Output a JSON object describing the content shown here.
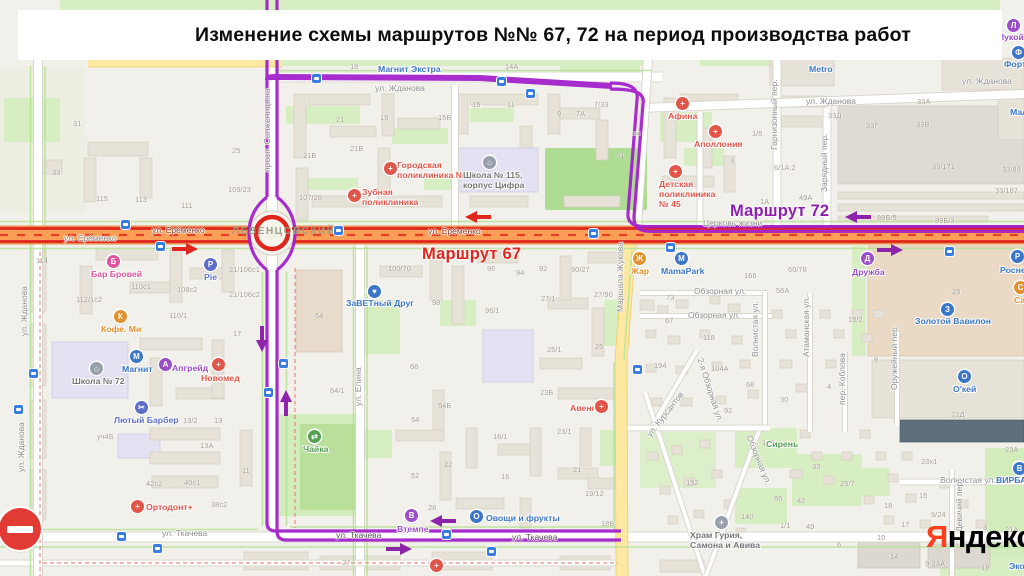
{
  "banner": {
    "title": "Изменение схемы маршрутов №№ 67, 72 на период производства работ"
  },
  "routes": {
    "r67": {
      "label": "Маршрут 67",
      "color": "#e0251c",
      "x": 422,
      "y": 245
    },
    "r72": {
      "label": "Маршрут 72",
      "color": "#a11ccb",
      "label_color": "#8d1fae",
      "x": 730,
      "y": 202
    }
  },
  "district": {
    "name": "ЛЕВЕНЦОВСКИЙ",
    "x": 232,
    "y": 226
  },
  "watermark": {
    "first": "Я",
    "rest": "ндекс",
    "accent": "#fc3f1d",
    "x": 926,
    "y": 519
  },
  "no_entry": {
    "x": 20,
    "y": 529
  },
  "colors": {
    "blue": "#3b76c9",
    "navy": "#5f6fc9",
    "red": "#e25549",
    "purple": "#9a4fc9",
    "orange": "#e2902e",
    "green": "#57a153",
    "pink": "#dd559c",
    "gray": "#767676",
    "school": "#98a1ab"
  },
  "map": {
    "streets": [
      {
        "t": "просп. Солженицына",
        "x": 263,
        "y": 172,
        "r": -90
      },
      {
        "t": "ул. Жданова",
        "x": 375,
        "y": 84
      },
      {
        "t": "ул. Жданова",
        "x": 806,
        "y": 97
      },
      {
        "t": "ул. Жданова",
        "x": 962,
        "y": 77
      },
      {
        "t": "ул. Ерёменко",
        "x": 152,
        "y": 226,
        "c": "#8a4634"
      },
      {
        "t": "ул. Ерёменко",
        "x": 64,
        "y": 234
      },
      {
        "t": "ул. Ерёменко",
        "x": 428,
        "y": 227,
        "c": "#8a4634"
      },
      {
        "t": "Гарнизонный пер.",
        "x": 770,
        "y": 150,
        "r": -90
      },
      {
        "t": "Зарядный пер.",
        "x": 820,
        "y": 192,
        "r": -90
      },
      {
        "t": "Маршала Жукова",
        "x": 616,
        "y": 312,
        "r": -90
      },
      {
        "t": "ул. Елина",
        "x": 354,
        "y": 406,
        "r": -90
      },
      {
        "t": "ул. Ткачева",
        "x": 162,
        "y": 529
      },
      {
        "t": "ул. Ткачева",
        "x": 336,
        "y": 531,
        "c": "#5c4f5a"
      },
      {
        "t": "ул. Ткачева",
        "x": 512,
        "y": 533,
        "c": "#5c4f5a"
      },
      {
        "t": "Обзорная ул.",
        "x": 694,
        "y": 287
      },
      {
        "t": "Обзорная ул.",
        "x": 688,
        "y": 311
      },
      {
        "t": "Обзорная ул.",
        "x": 753,
        "y": 434,
        "r": 68
      },
      {
        "t": "2-я Обзорная ул.",
        "x": 704,
        "y": 357,
        "r": 72
      },
      {
        "t": "ул. Курсантов",
        "x": 645,
        "y": 433,
        "r": -52
      },
      {
        "t": "Волнистая ул.",
        "x": 751,
        "y": 357,
        "r": -90
      },
      {
        "t": "Волнистая ул.",
        "x": 940,
        "y": 476
      },
      {
        "t": "Атаманская ул.",
        "x": 802,
        "y": 357,
        "r": -90
      },
      {
        "t": "пер. Коблова",
        "x": 838,
        "y": 405,
        "r": -90
      },
      {
        "t": "Оружейный пер.",
        "x": 890,
        "y": 390,
        "r": -90
      },
      {
        "t": "Девичий пер.",
        "x": 955,
        "y": 532,
        "r": -90
      },
      {
        "t": "ул. Жданова",
        "x": 20,
        "y": 336,
        "r": -90
      },
      {
        "t": "ул. Жданова",
        "x": 17,
        "y": 472,
        "r": -90
      },
      {
        "t": "Церковь жизни",
        "x": 703,
        "y": 219
      }
    ],
    "pois": [
      {
        "t": "Магнит Экстра",
        "x": 378,
        "y": 64,
        "c": "blue"
      },
      {
        "t": "Metro",
        "x": 809,
        "y": 64,
        "c": "blue"
      },
      {
        "t": "Лукойл",
        "x": 998,
        "y": 32,
        "c": "purple",
        "icon": {
          "x": 1007,
          "y": 19,
          "bg": "purple",
          "g": "Л"
        }
      },
      {
        "t": "Форту",
        "x": 1004,
        "y": 59,
        "c": "blue",
        "icon": {
          "x": 1012,
          "y": 46,
          "bg": "blue",
          "g": "Ф"
        }
      },
      {
        "t": "Мал",
        "x": 1010,
        "y": 107,
        "c": "blue"
      },
      {
        "t": "Афина",
        "x": 668,
        "y": 111,
        "c": "red",
        "icon": {
          "x": 676,
          "y": 97,
          "bg": "red",
          "g": "+"
        }
      },
      {
        "t": "Аполлония",
        "x": 694,
        "y": 139,
        "c": "red",
        "icon": {
          "x": 709,
          "y": 125,
          "bg": "red",
          "g": "+"
        }
      },
      {
        "t": "Городская\nполиклиника №42",
        "x": 397,
        "y": 160,
        "c": "red",
        "icon": {
          "x": 384,
          "y": 162,
          "bg": "red",
          "g": "+"
        }
      },
      {
        "t": "Школа № 115,\nкорпус Цифра",
        "x": 463,
        "y": 170,
        "c": "gray",
        "icon": {
          "x": 483,
          "y": 156,
          "bg": "school",
          "g": "⌂"
        }
      },
      {
        "t": "Зубная\nполиклиника",
        "x": 362,
        "y": 187,
        "c": "red",
        "icon": {
          "x": 348,
          "y": 189,
          "bg": "red",
          "g": "+"
        }
      },
      {
        "t": "Детская\nполиклиника\n№ 45",
        "x": 659,
        "y": 179,
        "c": "red",
        "icon": {
          "x": 669,
          "y": 165,
          "bg": "red",
          "g": "+"
        }
      },
      {
        "t": "Бар Бровей",
        "x": 91,
        "y": 269,
        "c": "pink",
        "icon": {
          "x": 107,
          "y": 255,
          "bg": "pink",
          "g": "Б"
        }
      },
      {
        "t": "Pie",
        "x": 204,
        "y": 272,
        "c": "navy",
        "icon": {
          "x": 204,
          "y": 258,
          "bg": "navy",
          "g": "P"
        }
      },
      {
        "t": "Кофе. Ми",
        "x": 101,
        "y": 324,
        "c": "orange",
        "icon": {
          "x": 114,
          "y": 310,
          "bg": "orange",
          "g": "К"
        }
      },
      {
        "t": "Магнит",
        "x": 122,
        "y": 364,
        "c": "blue",
        "icon": {
          "x": 130,
          "y": 350,
          "bg": "blue",
          "g": "М"
        }
      },
      {
        "t": "Апгрейд",
        "x": 172,
        "y": 363,
        "c": "purple",
        "icon": {
          "x": 159,
          "y": 358,
          "bg": "purple",
          "g": "А"
        }
      },
      {
        "t": "Новомед",
        "x": 201,
        "y": 373,
        "c": "red",
        "icon": {
          "x": 212,
          "y": 358,
          "bg": "red",
          "g": "+"
        }
      },
      {
        "t": "Школа № 72",
        "x": 72,
        "y": 376,
        "c": "gray",
        "icon": {
          "x": 90,
          "y": 362,
          "bg": "school",
          "g": "⌂"
        }
      },
      {
        "t": "Лютый Барбер",
        "x": 114,
        "y": 415,
        "c": "navy",
        "icon": {
          "x": 135,
          "y": 401,
          "bg": "navy",
          "g": "✂"
        }
      },
      {
        "t": "Ортодонт+",
        "x": 146,
        "y": 502,
        "c": "red",
        "icon": {
          "x": 131,
          "y": 500,
          "bg": "red",
          "g": "+"
        }
      },
      {
        "t": "ЗаВЕТный Друг",
        "x": 346,
        "y": 298,
        "c": "blue",
        "icon": {
          "x": 368,
          "y": 285,
          "bg": "blue",
          "g": "♥"
        }
      },
      {
        "t": "Чайка",
        "x": 303,
        "y": 444,
        "c": "green",
        "icon": {
          "x": 308,
          "y": 430,
          "bg": "green",
          "g": "⇄"
        }
      },
      {
        "t": "Втемпе",
        "x": 397,
        "y": 524,
        "c": "purple",
        "icon": {
          "x": 405,
          "y": 509,
          "bg": "purple",
          "g": "В"
        }
      },
      {
        "t": "Овощи и фрукты",
        "x": 486,
        "y": 513,
        "c": "blue",
        "icon": {
          "x": 470,
          "y": 510,
          "bg": "blue",
          "g": "О"
        }
      },
      {
        "t": "Авеню",
        "x": 570,
        "y": 403,
        "c": "red",
        "icon": {
          "x": 595,
          "y": 400,
          "bg": "red",
          "g": "+"
        }
      },
      {
        "t": "Жар",
        "x": 631,
        "y": 266,
        "c": "orange",
        "icon": {
          "x": 633,
          "y": 252,
          "bg": "orange",
          "g": "Ж"
        }
      },
      {
        "t": "MamaPark",
        "x": 661,
        "y": 266,
        "c": "blue",
        "icon": {
          "x": 675,
          "y": 252,
          "bg": "blue",
          "g": "М"
        }
      },
      {
        "t": "Дружба",
        "x": 852,
        "y": 267,
        "c": "purple",
        "icon": {
          "x": 861,
          "y": 252,
          "bg": "purple",
          "g": "Д"
        }
      },
      {
        "t": "Золотой Вавилон",
        "x": 915,
        "y": 316,
        "c": "blue",
        "icon": {
          "x": 941,
          "y": 303,
          "bg": "blue",
          "g": "З"
        }
      },
      {
        "t": "О'кей",
        "x": 953,
        "y": 384,
        "c": "blue",
        "icon": {
          "x": 958,
          "y": 370,
          "bg": "blue",
          "g": "О"
        }
      },
      {
        "t": "Роснефть",
        "x": 1000,
        "y": 265,
        "c": "blue",
        "icon": {
          "x": 1011,
          "y": 250,
          "bg": "blue",
          "g": "Р"
        }
      },
      {
        "t": "Са",
        "x": 1014,
        "y": 295,
        "c": "orange",
        "icon": {
          "x": 1014,
          "y": 281,
          "bg": "orange",
          "g": "С"
        }
      },
      {
        "t": "Храм Гурия,\nСамона и Авива",
        "x": 690,
        "y": 530,
        "c": "gray",
        "icon": {
          "x": 715,
          "y": 516,
          "bg": "school",
          "g": "+"
        }
      },
      {
        "t": "Сирень",
        "x": 766,
        "y": 439,
        "c": "green"
      },
      {
        "t": "ВИРБА",
        "x": 996,
        "y": 475,
        "c": "blue",
        "icon": {
          "x": 1013,
          "y": 462,
          "bg": "blue",
          "g": "В"
        }
      },
      {
        "t": "Эко",
        "x": 1009,
        "y": 561,
        "c": "blue"
      },
      {
        "t": "",
        "x": 437,
        "y": 566,
        "c": "red",
        "icon": {
          "x": 430,
          "y": 559,
          "bg": "red",
          "g": "+"
        }
      }
    ],
    "numbers": [
      [
        "31",
        73,
        120
      ],
      [
        "33",
        52,
        169
      ],
      [
        "25",
        232,
        147
      ],
      [
        "115",
        96,
        195
      ],
      [
        "113",
        135,
        196
      ],
      [
        "111",
        181,
        202
      ],
      [
        "109/23",
        228,
        186
      ],
      [
        "107/20",
        299,
        194
      ],
      [
        "18",
        350,
        63
      ],
      [
        "14А",
        505,
        63
      ],
      [
        "21",
        336,
        116
      ],
      [
        "19",
        380,
        114
      ],
      [
        "15Б",
        438,
        114
      ],
      [
        "15",
        472,
        101
      ],
      [
        "11",
        507,
        101
      ],
      [
        "9",
        557,
        110
      ],
      [
        "7А",
        576,
        110
      ],
      [
        "7/33",
        594,
        101
      ],
      [
        "21Б",
        303,
        152
      ],
      [
        "21В",
        350,
        145
      ],
      [
        "31",
        616,
        152
      ],
      [
        "34",
        632,
        130
      ],
      [
        "1/5",
        752,
        130
      ],
      [
        "3",
        730,
        157
      ],
      [
        "6/1А:2",
        774,
        164
      ],
      [
        "1А",
        760,
        198
      ],
      [
        "49А",
        799,
        194
      ],
      [
        "33А",
        917,
        98
      ],
      [
        "33Д",
        828,
        112
      ],
      [
        "33Г",
        866,
        122
      ],
      [
        "33В",
        916,
        121
      ],
      [
        "33/171",
        932,
        163
      ],
      [
        "33/89",
        1002,
        166
      ],
      [
        "33/187",
        995,
        187
      ],
      [
        "89Б/5",
        877,
        214
      ],
      [
        "89Б/3",
        935,
        217
      ],
      [
        "114",
        36,
        257
      ],
      [
        "112/1с2",
        76,
        296
      ],
      [
        "110с1",
        131,
        283
      ],
      [
        "108с2",
        177,
        286
      ],
      [
        "110/1",
        169,
        312
      ],
      [
        "21/106с1",
        229,
        266
      ],
      [
        "21/106с2",
        229,
        291
      ],
      [
        "17",
        233,
        330
      ],
      [
        "64",
        315,
        312
      ],
      [
        "64/1",
        330,
        387
      ],
      [
        "уч4Б",
        97,
        433
      ],
      [
        "13/2",
        183,
        417
      ],
      [
        "13",
        214,
        417
      ],
      [
        "13А",
        200,
        442
      ],
      [
        "42с2",
        146,
        480
      ],
      [
        "40с1",
        184,
        479
      ],
      [
        "38с2",
        211,
        501
      ],
      [
        "27",
        342,
        559
      ],
      [
        "100/70",
        388,
        265
      ],
      [
        "98",
        432,
        299
      ],
      [
        "96",
        487,
        265
      ],
      [
        "94",
        516,
        269
      ],
      [
        "92",
        539,
        265
      ],
      [
        "90/27",
        571,
        266
      ],
      [
        "96/1",
        485,
        307
      ],
      [
        "27/1",
        541,
        295
      ],
      [
        "27/90",
        594,
        291
      ],
      [
        "66",
        410,
        363
      ],
      [
        "25/1",
        547,
        346
      ],
      [
        "25",
        595,
        343
      ],
      [
        "23Б",
        540,
        389
      ],
      [
        "54Б",
        438,
        402
      ],
      [
        "54",
        411,
        416
      ],
      [
        "16/1",
        493,
        433
      ],
      [
        "23/1",
        557,
        428
      ],
      [
        "22",
        444,
        461
      ],
      [
        "52",
        411,
        472
      ],
      [
        "16",
        501,
        473
      ],
      [
        "21",
        573,
        466
      ],
      [
        "28",
        428,
        504
      ],
      [
        "19/12",
        585,
        490
      ],
      [
        "18Б",
        601,
        520
      ],
      [
        "11",
        242,
        467
      ],
      [
        "60/78",
        788,
        266
      ],
      [
        "56А",
        776,
        287
      ],
      [
        "166",
        744,
        272
      ],
      [
        "73",
        666,
        294
      ],
      [
        "67",
        665,
        317
      ],
      [
        "118",
        703,
        334
      ],
      [
        "194",
        654,
        362
      ],
      [
        "104А",
        711,
        365
      ],
      [
        "68",
        746,
        381
      ],
      [
        "92",
        724,
        407
      ],
      [
        "30",
        780,
        396
      ],
      [
        "15/2",
        848,
        316
      ],
      [
        "9",
        874,
        356
      ],
      [
        "4",
        827,
        383
      ],
      [
        "25",
        952,
        288
      ],
      [
        "23Д",
        951,
        411
      ],
      [
        "23х1",
        921,
        458
      ],
      [
        "23А",
        1005,
        446
      ],
      [
        "21А",
        1005,
        526
      ],
      [
        "3",
        983,
        524
      ],
      [
        "9-23А",
        925,
        560
      ],
      [
        "170",
        762,
        439
      ],
      [
        "152",
        686,
        479
      ],
      [
        "140",
        741,
        513
      ],
      [
        "55",
        774,
        495
      ],
      [
        "42",
        797,
        497
      ],
      [
        "49",
        806,
        523
      ],
      [
        "1/1",
        780,
        522
      ],
      [
        "33",
        812,
        463
      ],
      [
        "25/7",
        840,
        480
      ],
      [
        "18",
        884,
        502
      ],
      [
        "15",
        919,
        492
      ],
      [
        "9/24",
        931,
        511
      ],
      [
        "14",
        890,
        553
      ],
      [
        "10",
        877,
        534
      ],
      [
        "17",
        901,
        521
      ],
      [
        "6",
        837,
        541
      ],
      [
        "19",
        981,
        564
      ]
    ],
    "stops": [
      [
        121,
        220
      ],
      [
        156,
        242
      ],
      [
        312,
        74
      ],
      [
        497,
        77
      ],
      [
        526,
        89
      ],
      [
        334,
        226
      ],
      [
        279,
        359
      ],
      [
        264,
        388
      ],
      [
        442,
        530
      ],
      [
        487,
        547
      ],
      [
        633,
        365
      ],
      [
        589,
        229
      ],
      [
        666,
        243
      ],
      [
        945,
        247
      ],
      [
        29,
        369
      ],
      [
        14,
        405
      ],
      [
        117,
        532
      ],
      [
        153,
        544
      ]
    ],
    "arrows": [
      {
        "x": 478,
        "y": 217,
        "d": "left",
        "c": "#e0251c"
      },
      {
        "x": 185,
        "y": 249,
        "d": "right",
        "c": "#e0251c"
      },
      {
        "x": 858,
        "y": 217,
        "d": "left",
        "c": "#8e24aa"
      },
      {
        "x": 890,
        "y": 250,
        "d": "right",
        "c": "#8e24aa"
      },
      {
        "x": 262,
        "y": 339,
        "d": "down",
        "c": "#8e24aa"
      },
      {
        "x": 286,
        "y": 403,
        "d": "up",
        "c": "#8e24aa"
      },
      {
        "x": 443,
        "y": 521,
        "d": "left",
        "c": "#8e24aa"
      },
      {
        "x": 399,
        "y": 549,
        "d": "right",
        "c": "#8e24aa"
      }
    ]
  }
}
